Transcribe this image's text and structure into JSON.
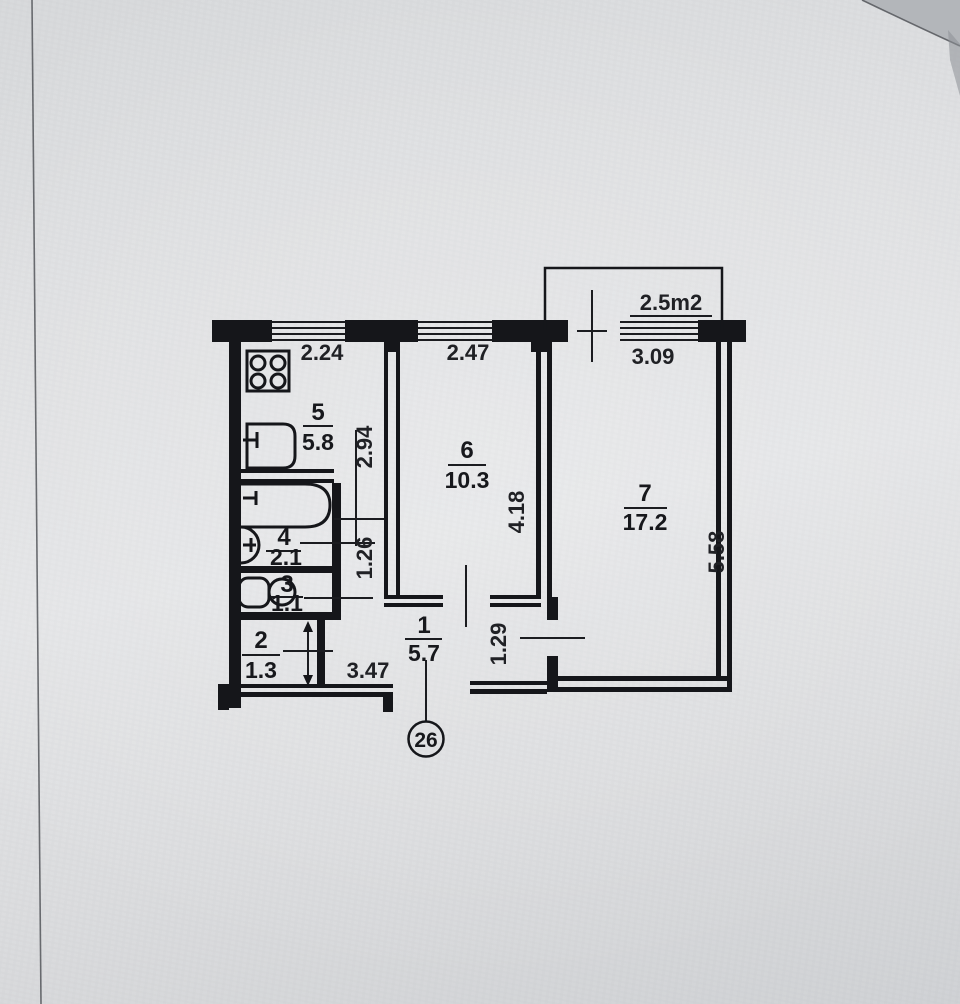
{
  "plan": {
    "apartment_number": "26",
    "balcony": {
      "area": "2.5m2"
    },
    "rooms": {
      "r1": {
        "number": "1",
        "area": "5.7"
      },
      "r2": {
        "number": "2",
        "area": "1.3"
      },
      "r3": {
        "number": "3",
        "area": "1.1"
      },
      "r4": {
        "number": "4",
        "area": "2.1"
      },
      "r5": {
        "number": "5",
        "area": "5.8"
      },
      "r6": {
        "number": "6",
        "area": "10.3"
      },
      "r7": {
        "number": "7",
        "area": "17.2"
      }
    },
    "dims": {
      "top1": "2.24",
      "top2": "2.47",
      "top3": "3.09",
      "kitchen_depth": "2.94",
      "room6_depth": "4.18",
      "room7_depth": "5.58",
      "hall_width": "1.26",
      "hall_width2": "1.29",
      "hall_length": "3.47"
    },
    "fixtures": [
      "stove-icon",
      "kitchen-sink-icon",
      "bathtub-icon",
      "wash-basin-icon",
      "toilet-icon"
    ]
  }
}
